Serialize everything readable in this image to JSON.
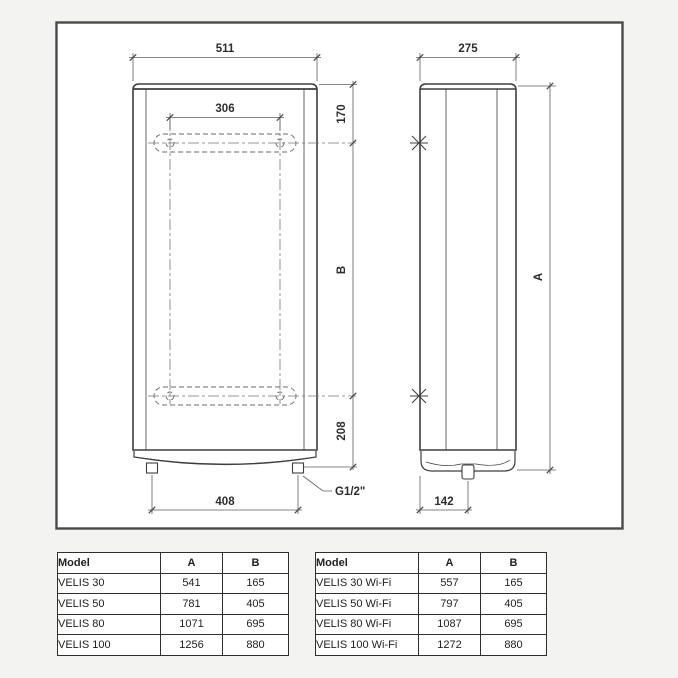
{
  "diagram": {
    "front_view": {
      "dim_overall_width": "511",
      "dim_bracket_width": "306",
      "dim_top_to_bracket": "170",
      "dim_bracket_span": "B",
      "dim_bracket_to_bottom": "208",
      "dim_pipe_spacing": "408",
      "pipe_connection_label": "G1/2\""
    },
    "side_view": {
      "dim_depth": "275",
      "dim_overall_height": "A",
      "dim_pipe_offset": "142"
    },
    "colors": {
      "frame": "#4a4a4a",
      "line": "#3e3e3e",
      "dim_line": "#5f5f5f"
    }
  },
  "tables": {
    "standard": {
      "headers": {
        "model": "Model",
        "a": "A",
        "b": "B"
      },
      "rows": [
        {
          "model": "VELIS 30",
          "a": "541",
          "b": "165"
        },
        {
          "model": "VELIS 50",
          "a": "781",
          "b": "405"
        },
        {
          "model": "VELIS 80",
          "a": "1071",
          "b": "695"
        },
        {
          "model": "VELIS 100",
          "a": "1256",
          "b": "880"
        }
      ]
    },
    "wifi": {
      "headers": {
        "model": "Model",
        "a": "A",
        "b": "B"
      },
      "rows": [
        {
          "model": "VELIS 30 Wi-Fi",
          "a": "557",
          "b": "165"
        },
        {
          "model": "VELIS 50 Wi-Fi",
          "a": "797",
          "b": "405"
        },
        {
          "model": "VELIS 80 Wi-Fi",
          "a": "1087",
          "b": "695"
        },
        {
          "model": "VELIS 100 Wi-Fi",
          "a": "1272",
          "b": "880"
        }
      ]
    }
  }
}
